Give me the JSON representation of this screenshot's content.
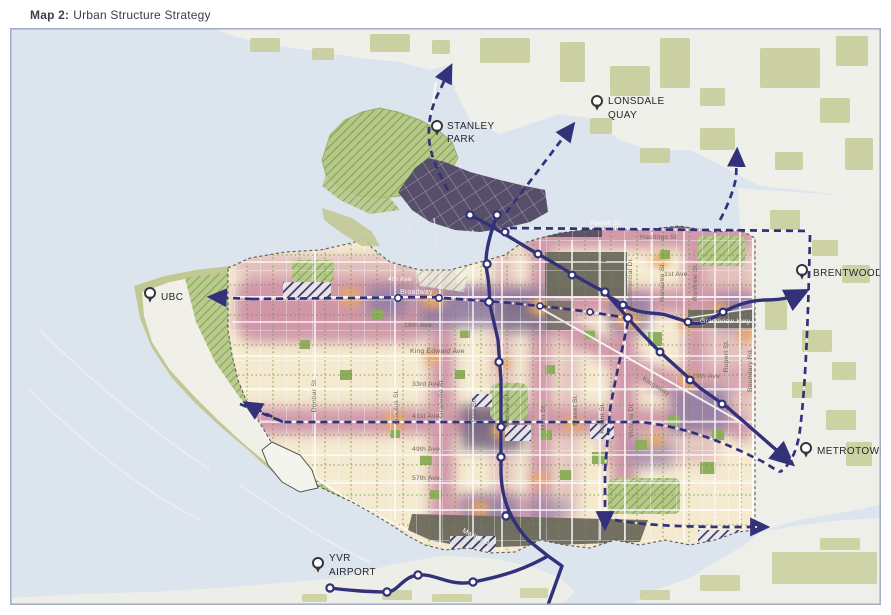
{
  "title": {
    "bold": "Map 2:",
    "rest": "Urban Structure Strategy"
  },
  "colors": {
    "water": "#dce4ee",
    "land": "#f0f0ea",
    "park_olive": "#c9cf9d",
    "park_hatch_green": "#a9c076",
    "city_base_cream": "#f5ead0",
    "corridor_pink": "#cb89a3",
    "node_orange": "#eaa763",
    "mixed_use_purple": "#8d7ba6",
    "downtown_dark_purple": "#574e6a",
    "industrial_gray": "#6b695d",
    "transit_navy": "#32317a",
    "frame_border": "#a2abc6"
  },
  "landmarks": {
    "stanley_park": {
      "line1": "STANLEY",
      "line2": "PARK"
    },
    "lonsdale_quay": {
      "line1": "LONSDALE",
      "line2": "QUAY"
    },
    "ubc": {
      "line1": "UBC"
    },
    "brentwood": {
      "line1": "BRENTWOOD"
    },
    "metrotown": {
      "line1": "METROTOWN"
    },
    "yvr_airport": {
      "line1": "YVR",
      "line2": "AIRPORT"
    }
  },
  "streets": {
    "powell": "Powell St",
    "hastings": "Hastings St",
    "first_ave": "1st Ave",
    "broadway": "Broadway",
    "fourth_ave": "4th Ave",
    "sixteenth_ave": "16th Ave",
    "king_edward": "King Edward Ave",
    "thirty_third": "33rd Ave.",
    "forty_first": "41st Ave.",
    "forty_ninth": "49th Ave.",
    "fifty_seventh": "57th Ave.",
    "twenty_ninth": "29th Ave.",
    "grandview": "Grandview Hwy",
    "marine": "Marine Dr",
    "kingsway": "Kingsway",
    "dunbar": "Dunbar St.",
    "arbutus": "Arbutus St.",
    "granville": "Granville St.",
    "oak": "Oak St.",
    "cambie": "Cambie St.",
    "main": "Main St.",
    "fraser": "Fraser St.",
    "knight": "Knight St.",
    "victoria": "Victoria Dr.",
    "clark": "Clark Dr",
    "commercial": "Commercial Dr.",
    "nanaimo": "Nanaimo St.",
    "renfrew": "Renfrew St.",
    "rupert": "Rupert St.",
    "boundary": "Boundary Rd."
  }
}
